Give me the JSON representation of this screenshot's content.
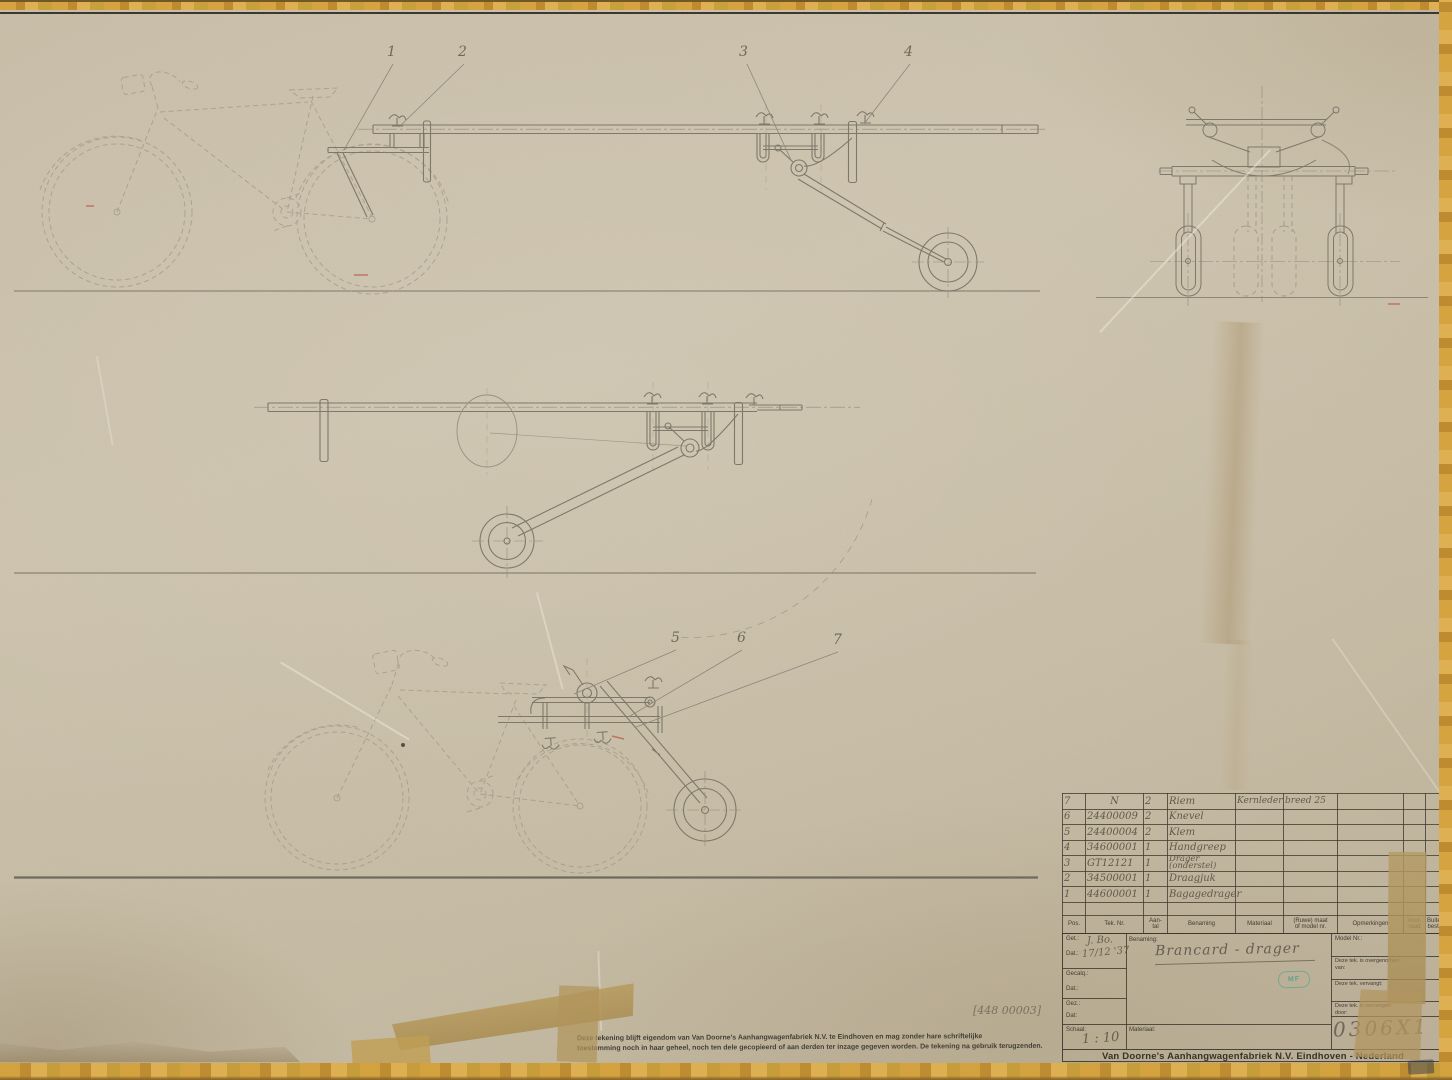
{
  "callouts": [
    "1",
    "2",
    "3",
    "4",
    "5",
    "6",
    "7"
  ],
  "note": "[448 00003]",
  "parts_table": {
    "headers": [
      "Pos.",
      "Tek. Nr.",
      "Aan-\ntal",
      "Benaming",
      "Materiaal",
      "(Ruwe) maat\nof model nr.",
      "Opmerkingen",
      "Voor-\nraad",
      "Buiten\nbest."
    ],
    "rows": [
      {
        "pos": "7",
        "tek_nr": "N",
        "aantal": "2",
        "benaming": "Riem",
        "materiaal": "Kernleder",
        "maat": "breed 25",
        "opmerkingen": "",
        "voorraad": "",
        "buiten": ""
      },
      {
        "pos": "6",
        "tek_nr": "24400009",
        "aantal": "2",
        "benaming": "Knevel",
        "materiaal": "",
        "maat": "",
        "opmerkingen": "",
        "voorraad": "",
        "buiten": ""
      },
      {
        "pos": "5",
        "tek_nr": "24400004",
        "aantal": "2",
        "benaming": "Klem",
        "materiaal": "",
        "maat": "",
        "opmerkingen": "",
        "voorraad": "",
        "buiten": ""
      },
      {
        "pos": "4",
        "tek_nr": "34600001",
        "aantal": "1",
        "benaming": "Handgreep",
        "materiaal": "",
        "maat": "",
        "opmerkingen": "",
        "voorraad": "",
        "buiten": ""
      },
      {
        "pos": "3",
        "tek_nr": "GT12121",
        "aantal": "1",
        "benaming": "Drager\n(onderstel)",
        "materiaal": "",
        "maat": "",
        "opmerkingen": "",
        "voorraad": "",
        "buiten": ""
      },
      {
        "pos": "2",
        "tek_nr": "34500001",
        "aantal": "1",
        "benaming": "Draagjuk",
        "materiaal": "",
        "maat": "",
        "opmerkingen": "",
        "voorraad": "",
        "buiten": ""
      },
      {
        "pos": "1",
        "tek_nr": "44600001",
        "aantal": "1",
        "benaming": "Bagagedrager",
        "materiaal": "",
        "maat": "",
        "opmerkingen": "",
        "voorraad": "",
        "buiten": ""
      }
    ]
  },
  "title_block": {
    "get_label": "Get.:",
    "get_value": "J. Bo.",
    "dat_label": "Dat.:",
    "dat_value": "17/12 '37",
    "gecalq_label": "Gecalq.:",
    "dat2_label": "Dat.:",
    "gez_label": "Gez.:",
    "dat3_label": "Dat:",
    "schaal_label": "Schaal:",
    "schaal_value": "1 : 10",
    "benaming_label": "Benaming:",
    "benaming_value": "Brancard - drager",
    "materiaal_label": "Materiaal:",
    "model_nr_label": "Model Nr.:",
    "overgenomen_label": "Deze tek. is overgenomen van:",
    "vervangt_label": "Deze tek. vervangt:",
    "vervangen_label": "Deze tek. is vervangen door:",
    "drawing_number": "0306X1",
    "stamp": "MF",
    "company": "Van Doorne's Aanhangwagenfabriek N.V. Eindhoven - Nederland"
  },
  "disclaimer": {
    "line1": "Deze tekening blijft eigendom van Van Doorne's Aanhangwagenfabriek N.V. te Eindhoven en mag zonder hare schriftelijke",
    "line2": "toestemming noch in haar geheel, noch ten dele gecopieerd of aan derden ter inzage gegeven worden. De tekening na gebruik terugzenden."
  },
  "colors": {
    "paper": "#c8bda6",
    "pencil_line": "#7b7567",
    "printed_ink": "#3a352b",
    "handwriting": "#5d5749",
    "tape_border": "#d8a43a",
    "tape_patch": "#b2975e",
    "stamp_green": "#5aa892",
    "red_mark": "#b8503c"
  }
}
